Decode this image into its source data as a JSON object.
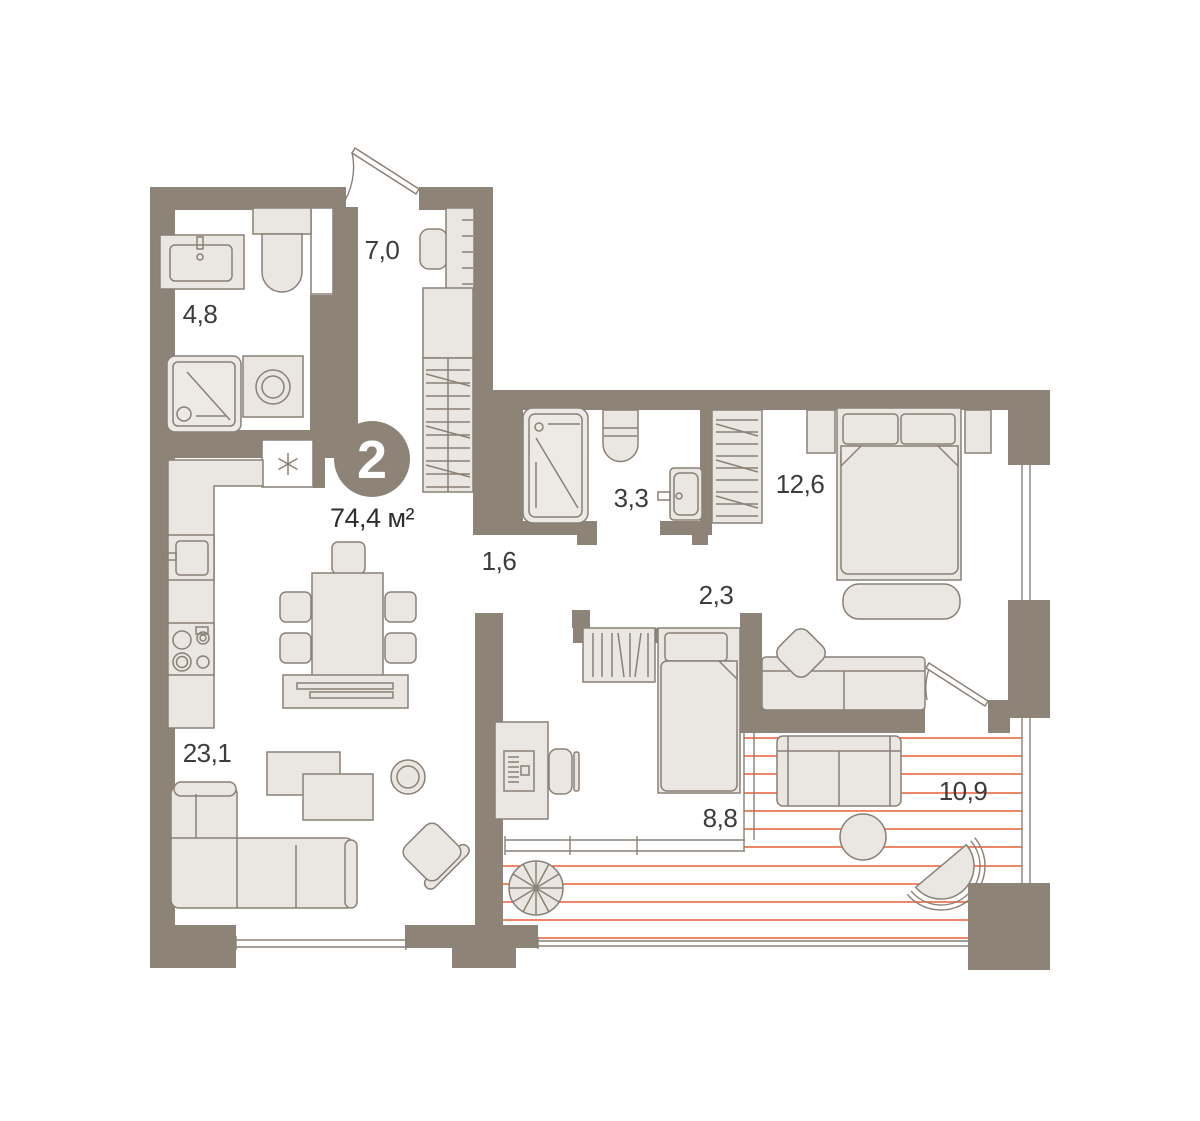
{
  "plan": {
    "badge": {
      "rooms_count": "2",
      "total_area": "74,4 м²"
    },
    "rooms": [
      {
        "id": "entrance-hall",
        "area": "7,0"
      },
      {
        "id": "bathroom",
        "area": "4,8"
      },
      {
        "id": "shower-room",
        "area": "3,3"
      },
      {
        "id": "bedroom-master",
        "area": "12,6"
      },
      {
        "id": "hallway",
        "area": "1,6"
      },
      {
        "id": "corridor",
        "area": "2,3"
      },
      {
        "id": "kitchen-living",
        "area": "23,1"
      },
      {
        "id": "bedroom-second",
        "area": "8,8"
      },
      {
        "id": "terrace",
        "area": "10,9"
      }
    ],
    "icons": {
      "niche_marker": "asterisk"
    },
    "colors": {
      "wall": "#8d8377",
      "furniture_fill": "#eae7e2",
      "outline": "#8a8076",
      "terrace_hatch": "#ed7452",
      "label_text": "#3c3c3c"
    }
  }
}
